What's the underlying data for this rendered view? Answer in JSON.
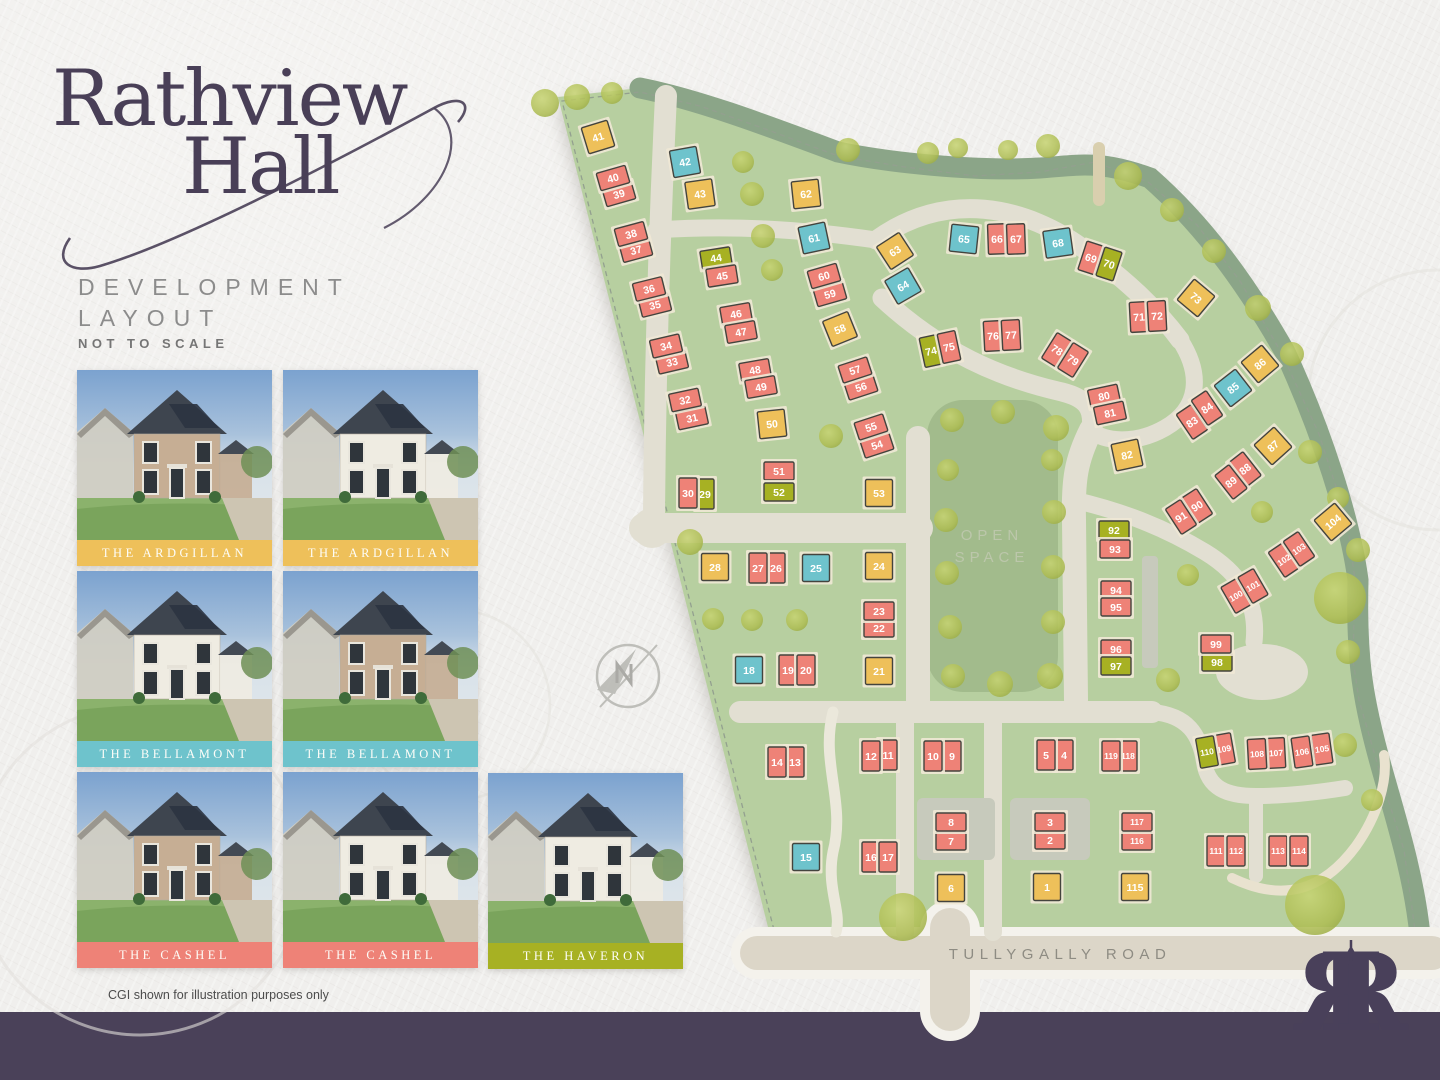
{
  "branding": {
    "title_line1": "Rathview",
    "title_line2": "Hall",
    "subtitle_line1": "DEVELOPMENT",
    "subtitle_line2": "LAYOUT",
    "scale_note": "NOT TO SCALE",
    "footer_note": "CGI shown for illustration purposes only",
    "monogram": "R",
    "accent_purple": "#493f57"
  },
  "photo_cards": [
    {
      "label": "THE ARDGILLAN",
      "type": "a",
      "variant": "brick"
    },
    {
      "label": "THE ARDGILLAN",
      "type": "a",
      "variant": "render"
    },
    {
      "label": "THE BELLAMONT",
      "type": "b",
      "variant": "render"
    },
    {
      "label": "THE BELLAMONT",
      "type": "b",
      "variant": "brick"
    },
    {
      "label": "THE CASHEL",
      "type": "c",
      "variant": "brick"
    },
    {
      "label": "THE CASHEL",
      "type": "c",
      "variant": "render"
    },
    {
      "label": "THE HAVERON",
      "type": "h",
      "variant": "render"
    }
  ],
  "map": {
    "open_space_line1": "OPEN",
    "open_space_line2": "SPACE",
    "road_label": "TULLYGALLY ROAD",
    "type_names": {
      "a": "THE ARDGILLAN",
      "b": "THE BELLAMONT",
      "c": "THE CASHEL",
      "h": "THE HAVERON"
    },
    "type_colors": {
      "a": "#eec05a",
      "b": "#6ec3cc",
      "c": "#ee8277",
      "h": "#a7b123"
    },
    "site_green": "#b7cfa0",
    "open_space_green": "#a2bb8c",
    "boundary_sage": "#8ba588",
    "road_color": "#e2dfd2",
    "footer_band_color": "#4a4159",
    "plots": [
      {
        "n": 1,
        "x": 1047,
        "y": 887,
        "t": "a",
        "w": 27,
        "h": 27,
        "r": 0
      },
      {
        "n": 2,
        "x": 1050,
        "y": 840,
        "t": "c",
        "w": 30,
        "h": 18,
        "r": 0
      },
      {
        "n": 3,
        "x": 1050,
        "y": 822,
        "t": "c",
        "w": 30,
        "h": 18,
        "r": 0
      },
      {
        "n": 4,
        "x": 1064,
        "y": 755,
        "t": "c",
        "w": 18,
        "h": 30,
        "r": 0
      },
      {
        "n": 5,
        "x": 1046,
        "y": 755,
        "t": "c",
        "w": 18,
        "h": 30,
        "r": 0
      },
      {
        "n": 6,
        "x": 951,
        "y": 888,
        "t": "a",
        "w": 27,
        "h": 27,
        "r": 0
      },
      {
        "n": 7,
        "x": 951,
        "y": 841,
        "t": "c",
        "w": 30,
        "h": 18,
        "r": 0
      },
      {
        "n": 8,
        "x": 951,
        "y": 822,
        "t": "c",
        "w": 30,
        "h": 18,
        "r": 0
      },
      {
        "n": 9,
        "x": 952,
        "y": 756,
        "t": "c",
        "w": 18,
        "h": 30,
        "r": 0
      },
      {
        "n": 10,
        "x": 933,
        "y": 756,
        "t": "c",
        "w": 18,
        "h": 30,
        "r": 0
      },
      {
        "n": 11,
        "x": 888,
        "y": 755,
        "t": "c",
        "w": 18,
        "h": 30,
        "r": 0
      },
      {
        "n": 12,
        "x": 871,
        "y": 756,
        "t": "c",
        "w": 18,
        "h": 30,
        "r": 0
      },
      {
        "n": 13,
        "x": 795,
        "y": 762,
        "t": "c",
        "w": 18,
        "h": 30,
        "r": 0
      },
      {
        "n": 14,
        "x": 777,
        "y": 762,
        "t": "c",
        "w": 18,
        "h": 30,
        "r": 0
      },
      {
        "n": 15,
        "x": 806,
        "y": 857,
        "t": "b",
        "w": 27,
        "h": 27,
        "r": 0
      },
      {
        "n": 16,
        "x": 871,
        "y": 857,
        "t": "c",
        "w": 18,
        "h": 30,
        "r": 0
      },
      {
        "n": 17,
        "x": 888,
        "y": 857,
        "t": "c",
        "w": 18,
        "h": 30,
        "r": 0
      },
      {
        "n": 18,
        "x": 749,
        "y": 670,
        "t": "b",
        "w": 27,
        "h": 27,
        "r": 0
      },
      {
        "n": 19,
        "x": 788,
        "y": 670,
        "t": "c",
        "w": 18,
        "h": 30,
        "r": 0
      },
      {
        "n": 20,
        "x": 806,
        "y": 670,
        "t": "c",
        "w": 18,
        "h": 30,
        "r": 0
      },
      {
        "n": 21,
        "x": 879,
        "y": 671,
        "t": "a",
        "w": 27,
        "h": 27,
        "r": 0
      },
      {
        "n": 22,
        "x": 879,
        "y": 628,
        "t": "c",
        "w": 30,
        "h": 18,
        "r": 0
      },
      {
        "n": 23,
        "x": 879,
        "y": 611,
        "t": "c",
        "w": 30,
        "h": 18,
        "r": 0
      },
      {
        "n": 24,
        "x": 879,
        "y": 566,
        "t": "a",
        "w": 27,
        "h": 27,
        "r": 0
      },
      {
        "n": 25,
        "x": 816,
        "y": 568,
        "t": "b",
        "w": 27,
        "h": 27,
        "r": 0
      },
      {
        "n": 26,
        "x": 776,
        "y": 568,
        "t": "c",
        "w": 18,
        "h": 30,
        "r": 0
      },
      {
        "n": 27,
        "x": 758,
        "y": 568,
        "t": "c",
        "w": 18,
        "h": 30,
        "r": 0
      },
      {
        "n": 28,
        "x": 715,
        "y": 567,
        "t": "a",
        "w": 27,
        "h": 27,
        "r": 0
      },
      {
        "n": 29,
        "x": 705,
        "y": 494,
        "t": "h",
        "w": 18,
        "h": 30,
        "r": 0
      },
      {
        "n": 30,
        "x": 688,
        "y": 493,
        "t": "c",
        "w": 18,
        "h": 30,
        "r": 0
      },
      {
        "n": 31,
        "x": 692,
        "y": 418,
        "t": "c",
        "w": 30,
        "h": 18,
        "r": -12
      },
      {
        "n": 32,
        "x": 685,
        "y": 400,
        "t": "c",
        "w": 30,
        "h": 18,
        "r": -12
      },
      {
        "n": 33,
        "x": 672,
        "y": 362,
        "t": "c",
        "w": 30,
        "h": 18,
        "r": -13
      },
      {
        "n": 34,
        "x": 666,
        "y": 346,
        "t": "c",
        "w": 30,
        "h": 18,
        "r": -13
      },
      {
        "n": 35,
        "x": 655,
        "y": 305,
        "t": "c",
        "w": 30,
        "h": 18,
        "r": -14
      },
      {
        "n": 36,
        "x": 649,
        "y": 289,
        "t": "c",
        "w": 30,
        "h": 18,
        "r": -14
      },
      {
        "n": 37,
        "x": 636,
        "y": 250,
        "t": "c",
        "w": 30,
        "h": 18,
        "r": -15
      },
      {
        "n": 38,
        "x": 631,
        "y": 234,
        "t": "c",
        "w": 30,
        "h": 18,
        "r": -15
      },
      {
        "n": 39,
        "x": 619,
        "y": 194,
        "t": "c",
        "w": 30,
        "h": 18,
        "r": -16
      },
      {
        "n": 40,
        "x": 613,
        "y": 178,
        "t": "c",
        "w": 30,
        "h": 18,
        "r": -16
      },
      {
        "n": 41,
        "x": 598,
        "y": 137,
        "t": "a",
        "w": 27,
        "h": 27,
        "r": -17
      },
      {
        "n": 42,
        "x": 685,
        "y": 162,
        "t": "b",
        "w": 27,
        "h": 27,
        "r": -10
      },
      {
        "n": 43,
        "x": 700,
        "y": 194,
        "t": "a",
        "w": 27,
        "h": 27,
        "r": -8
      },
      {
        "n": 44,
        "x": 716,
        "y": 258,
        "t": "h",
        "w": 30,
        "h": 18,
        "r": -9
      },
      {
        "n": 45,
        "x": 722,
        "y": 276,
        "t": "c",
        "w": 30,
        "h": 18,
        "r": -9
      },
      {
        "n": 46,
        "x": 736,
        "y": 314,
        "t": "c",
        "w": 30,
        "h": 18,
        "r": -10
      },
      {
        "n": 47,
        "x": 741,
        "y": 332,
        "t": "c",
        "w": 30,
        "h": 18,
        "r": -10
      },
      {
        "n": 48,
        "x": 755,
        "y": 370,
        "t": "c",
        "w": 30,
        "h": 18,
        "r": -10
      },
      {
        "n": 49,
        "x": 761,
        "y": 387,
        "t": "c",
        "w": 30,
        "h": 18,
        "r": -10
      },
      {
        "n": 50,
        "x": 772,
        "y": 424,
        "t": "a",
        "w": 27,
        "h": 27,
        "r": -6
      },
      {
        "n": 51,
        "x": 779,
        "y": 471,
        "t": "c",
        "w": 30,
        "h": 18,
        "r": 0
      },
      {
        "n": 52,
        "x": 779,
        "y": 492,
        "t": "h",
        "w": 30,
        "h": 18,
        "r": 0
      },
      {
        "n": 53,
        "x": 879,
        "y": 493,
        "t": "a",
        "w": 27,
        "h": 27,
        "r": 0
      },
      {
        "n": 54,
        "x": 877,
        "y": 445,
        "t": "c",
        "w": 30,
        "h": 18,
        "r": -18
      },
      {
        "n": 55,
        "x": 871,
        "y": 427,
        "t": "c",
        "w": 30,
        "h": 18,
        "r": -18
      },
      {
        "n": 56,
        "x": 861,
        "y": 387,
        "t": "c",
        "w": 30,
        "h": 18,
        "r": -18
      },
      {
        "n": 57,
        "x": 855,
        "y": 370,
        "t": "c",
        "w": 30,
        "h": 18,
        "r": -18
      },
      {
        "n": 58,
        "x": 840,
        "y": 329,
        "t": "a",
        "w": 27,
        "h": 27,
        "r": -22
      },
      {
        "n": 59,
        "x": 830,
        "y": 294,
        "t": "c",
        "w": 30,
        "h": 18,
        "r": -16
      },
      {
        "n": 60,
        "x": 824,
        "y": 276,
        "t": "c",
        "w": 30,
        "h": 18,
        "r": -16
      },
      {
        "n": 61,
        "x": 814,
        "y": 238,
        "t": "b",
        "w": 27,
        "h": 27,
        "r": -12
      },
      {
        "n": 62,
        "x": 806,
        "y": 194,
        "t": "a",
        "w": 27,
        "h": 27,
        "r": -6
      },
      {
        "n": 63,
        "x": 895,
        "y": 251,
        "t": "a",
        "w": 27,
        "h": 27,
        "r": -33
      },
      {
        "n": 64,
        "x": 903,
        "y": 286,
        "t": "b",
        "w": 27,
        "h": 27,
        "r": -30
      },
      {
        "n": 65,
        "x": 964,
        "y": 239,
        "t": "b",
        "w": 27,
        "h": 27,
        "r": 6
      },
      {
        "n": 66,
        "x": 997,
        "y": 239,
        "t": "c",
        "w": 18,
        "h": 30,
        "r": -2
      },
      {
        "n": 67,
        "x": 1016,
        "y": 239,
        "t": "c",
        "w": 18,
        "h": 30,
        "r": -2
      },
      {
        "n": 68,
        "x": 1058,
        "y": 243,
        "t": "b",
        "w": 27,
        "h": 27,
        "r": -8
      },
      {
        "n": 69,
        "x": 1091,
        "y": 258,
        "t": "c",
        "w": 18,
        "h": 30,
        "r": 18
      },
      {
        "n": 70,
        "x": 1109,
        "y": 264,
        "t": "h",
        "w": 18,
        "h": 30,
        "r": 18
      },
      {
        "n": 71,
        "x": 1139,
        "y": 317,
        "t": "c",
        "w": 18,
        "h": 30,
        "r": -3
      },
      {
        "n": 72,
        "x": 1157,
        "y": 316,
        "t": "c",
        "w": 18,
        "h": 30,
        "r": -3
      },
      {
        "n": 73,
        "x": 1196,
        "y": 298,
        "t": "a",
        "w": 27,
        "h": 27,
        "r": 40
      },
      {
        "n": 74,
        "x": 931,
        "y": 351,
        "t": "h",
        "w": 18,
        "h": 30,
        "r": -12
      },
      {
        "n": 75,
        "x": 949,
        "y": 347,
        "t": "c",
        "w": 18,
        "h": 30,
        "r": -12
      },
      {
        "n": 76,
        "x": 993,
        "y": 336,
        "t": "c",
        "w": 18,
        "h": 30,
        "r": -3
      },
      {
        "n": 77,
        "x": 1011,
        "y": 335,
        "t": "c",
        "w": 18,
        "h": 30,
        "r": -3
      },
      {
        "n": 78,
        "x": 1057,
        "y": 350,
        "t": "c",
        "w": 18,
        "h": 30,
        "r": 32
      },
      {
        "n": 79,
        "x": 1073,
        "y": 360,
        "t": "c",
        "w": 18,
        "h": 30,
        "r": 32
      },
      {
        "n": 80,
        "x": 1104,
        "y": 396,
        "t": "c",
        "w": 30,
        "h": 18,
        "r": -12
      },
      {
        "n": 81,
        "x": 1110,
        "y": 413,
        "t": "c",
        "w": 30,
        "h": 18,
        "r": -12
      },
      {
        "n": 82,
        "x": 1127,
        "y": 455,
        "t": "a",
        "w": 27,
        "h": 27,
        "r": -12
      },
      {
        "n": 83,
        "x": 1192,
        "y": 422,
        "t": "c",
        "w": 18,
        "h": 30,
        "r": -34
      },
      {
        "n": 84,
        "x": 1207,
        "y": 408,
        "t": "c",
        "w": 18,
        "h": 30,
        "r": -34
      },
      {
        "n": 85,
        "x": 1233,
        "y": 388,
        "t": "b",
        "w": 27,
        "h": 27,
        "r": -38
      },
      {
        "n": 86,
        "x": 1260,
        "y": 364,
        "t": "a",
        "w": 27,
        "h": 27,
        "r": -40
      },
      {
        "n": 87,
        "x": 1273,
        "y": 446,
        "t": "a",
        "w": 27,
        "h": 27,
        "r": -42
      },
      {
        "n": 88,
        "x": 1245,
        "y": 469,
        "t": "c",
        "w": 18,
        "h": 30,
        "r": -38
      },
      {
        "n": 89,
        "x": 1231,
        "y": 482,
        "t": "c",
        "w": 18,
        "h": 30,
        "r": -38
      },
      {
        "n": 90,
        "x": 1197,
        "y": 506,
        "t": "c",
        "w": 18,
        "h": 30,
        "r": -33
      },
      {
        "n": 91,
        "x": 1181,
        "y": 517,
        "t": "c",
        "w": 18,
        "h": 30,
        "r": -33
      },
      {
        "n": 92,
        "x": 1114,
        "y": 530,
        "t": "h",
        "w": 30,
        "h": 18,
        "r": 0
      },
      {
        "n": 93,
        "x": 1115,
        "y": 549,
        "t": "c",
        "w": 30,
        "h": 18,
        "r": 0
      },
      {
        "n": 94,
        "x": 1116,
        "y": 590,
        "t": "c",
        "w": 30,
        "h": 18,
        "r": 0
      },
      {
        "n": 95,
        "x": 1116,
        "y": 607,
        "t": "c",
        "w": 30,
        "h": 18,
        "r": 0
      },
      {
        "n": 96,
        "x": 1116,
        "y": 649,
        "t": "c",
        "w": 30,
        "h": 18,
        "r": 0
      },
      {
        "n": 97,
        "x": 1116,
        "y": 666,
        "t": "h",
        "w": 30,
        "h": 18,
        "r": 0
      },
      {
        "n": 98,
        "x": 1217,
        "y": 662,
        "t": "h",
        "w": 30,
        "h": 18,
        "r": 0
      },
      {
        "n": 99,
        "x": 1216,
        "y": 644,
        "t": "c",
        "w": 30,
        "h": 18,
        "r": 0
      },
      {
        "n": 100,
        "x": 1236,
        "y": 596,
        "t": "c",
        "w": 18,
        "h": 30,
        "r": -30
      },
      {
        "n": 101,
        "x": 1253,
        "y": 586,
        "t": "c",
        "w": 18,
        "h": 30,
        "r": -30
      },
      {
        "n": 102,
        "x": 1284,
        "y": 560,
        "t": "c",
        "w": 18,
        "h": 30,
        "r": -34
      },
      {
        "n": 103,
        "x": 1299,
        "y": 549,
        "t": "c",
        "w": 18,
        "h": 30,
        "r": -34
      },
      {
        "n": 104,
        "x": 1333,
        "y": 522,
        "t": "a",
        "w": 27,
        "h": 27,
        "r": -40
      },
      {
        "n": 105,
        "x": 1322,
        "y": 749,
        "t": "c",
        "w": 18,
        "h": 30,
        "r": -8
      },
      {
        "n": 106,
        "x": 1302,
        "y": 752,
        "t": "c",
        "w": 18,
        "h": 30,
        "r": -8
      },
      {
        "n": 107,
        "x": 1276,
        "y": 753,
        "t": "c",
        "w": 18,
        "h": 30,
        "r": -3
      },
      {
        "n": 108,
        "x": 1257,
        "y": 754,
        "t": "c",
        "w": 18,
        "h": 30,
        "r": -3
      },
      {
        "n": 109,
        "x": 1224,
        "y": 749,
        "t": "c",
        "w": 18,
        "h": 30,
        "r": -10
      },
      {
        "n": 110,
        "x": 1207,
        "y": 752,
        "t": "h",
        "w": 18,
        "h": 30,
        "r": -10
      },
      {
        "n": 111,
        "x": 1216,
        "y": 851,
        "t": "c",
        "w": 18,
        "h": 30,
        "r": 0
      },
      {
        "n": 112,
        "x": 1236,
        "y": 851,
        "t": "c",
        "w": 18,
        "h": 30,
        "r": 0
      },
      {
        "n": 113,
        "x": 1278,
        "y": 851,
        "t": "c",
        "w": 18,
        "h": 30,
        "r": 0
      },
      {
        "n": 114,
        "x": 1299,
        "y": 851,
        "t": "c",
        "w": 18,
        "h": 30,
        "r": 0
      },
      {
        "n": 115,
        "x": 1135,
        "y": 887,
        "t": "a",
        "w": 27,
        "h": 27,
        "r": 0
      },
      {
        "n": 116,
        "x": 1137,
        "y": 841,
        "t": "c",
        "w": 30,
        "h": 18,
        "r": 0
      },
      {
        "n": 117,
        "x": 1137,
        "y": 822,
        "t": "c",
        "w": 30,
        "h": 18,
        "r": 0
      },
      {
        "n": 118,
        "x": 1128,
        "y": 756,
        "t": "c",
        "w": 18,
        "h": 30,
        "r": 0
      },
      {
        "n": 119,
        "x": 1111,
        "y": 756,
        "t": "c",
        "w": 18,
        "h": 30,
        "r": 0
      }
    ]
  }
}
